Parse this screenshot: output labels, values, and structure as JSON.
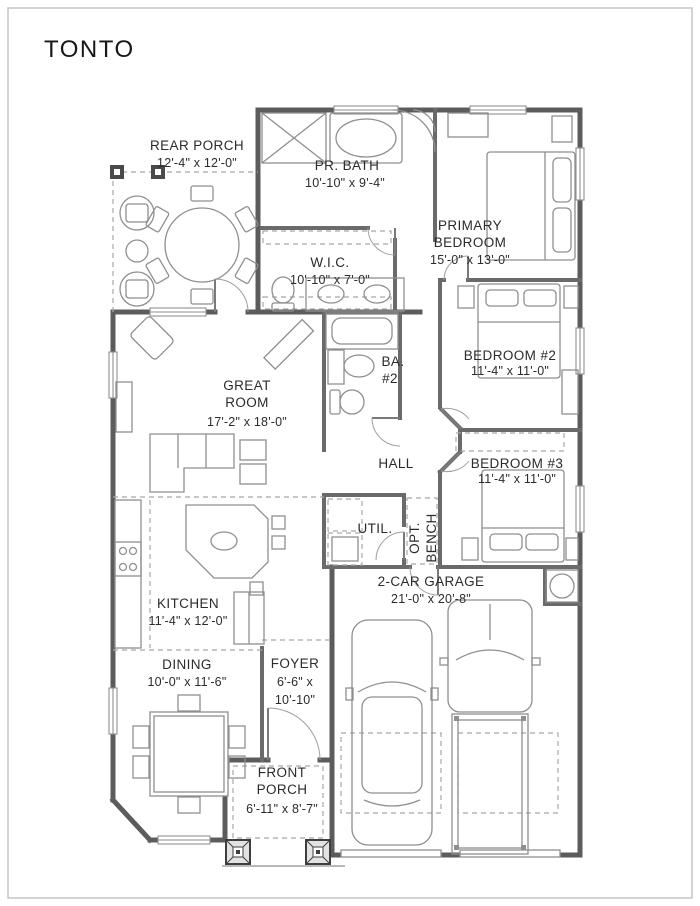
{
  "title": "TONTO",
  "colors": {
    "wall": "#5c5c5c",
    "furniture_line": "#8f8f8f",
    "label_text": "#2b2b2b",
    "dashed_line": "#a8a8a8",
    "background": "#ffffff"
  },
  "rooms": {
    "rear_porch": {
      "name": "REAR PORCH",
      "dims": "12'-4\" x 12'-0\""
    },
    "pr_bath": {
      "name": "PR. BATH",
      "dims": "10'-10\" x 9'-4\""
    },
    "primary_bedroom": {
      "name1": "PRIMARY",
      "name2": "BEDROOM",
      "dims": "15'-0\" x 13'-0\""
    },
    "wic": {
      "name": "W.I.C.",
      "dims": "10'-10\" x 7'-0\""
    },
    "great_room": {
      "name1": "GREAT",
      "name2": "ROOM",
      "dims": "17'-2\" x 18'-0\""
    },
    "bedroom2": {
      "name": "BEDROOM #2",
      "dims": "11'-4\" x 11'-0\""
    },
    "bath2": {
      "name1": "BA.",
      "name2": "#2"
    },
    "hall": {
      "name": "HALL"
    },
    "bedroom3": {
      "name": "BEDROOM #3",
      "dims": "11'-4\" x 11'-0\""
    },
    "util": {
      "name": "UTIL."
    },
    "opt_bench": {
      "name1": "OPT.",
      "name2": "BENCH"
    },
    "kitchen": {
      "name": "KITCHEN",
      "dims": "11'-4\" x 12'-0\""
    },
    "dining": {
      "name": "DINING",
      "dims": "10'-0\" x 11'-6\""
    },
    "foyer": {
      "name": "FOYER",
      "dims_line1": "6'-6\" x",
      "dims_line2": "10'-10\""
    },
    "garage": {
      "name": "2-CAR GARAGE",
      "dims": "21'-0\" x 20'-8\""
    },
    "front_porch": {
      "name1": "FRONT",
      "name2": "PORCH",
      "dims": "6'-11\" x 8'-7\""
    }
  }
}
